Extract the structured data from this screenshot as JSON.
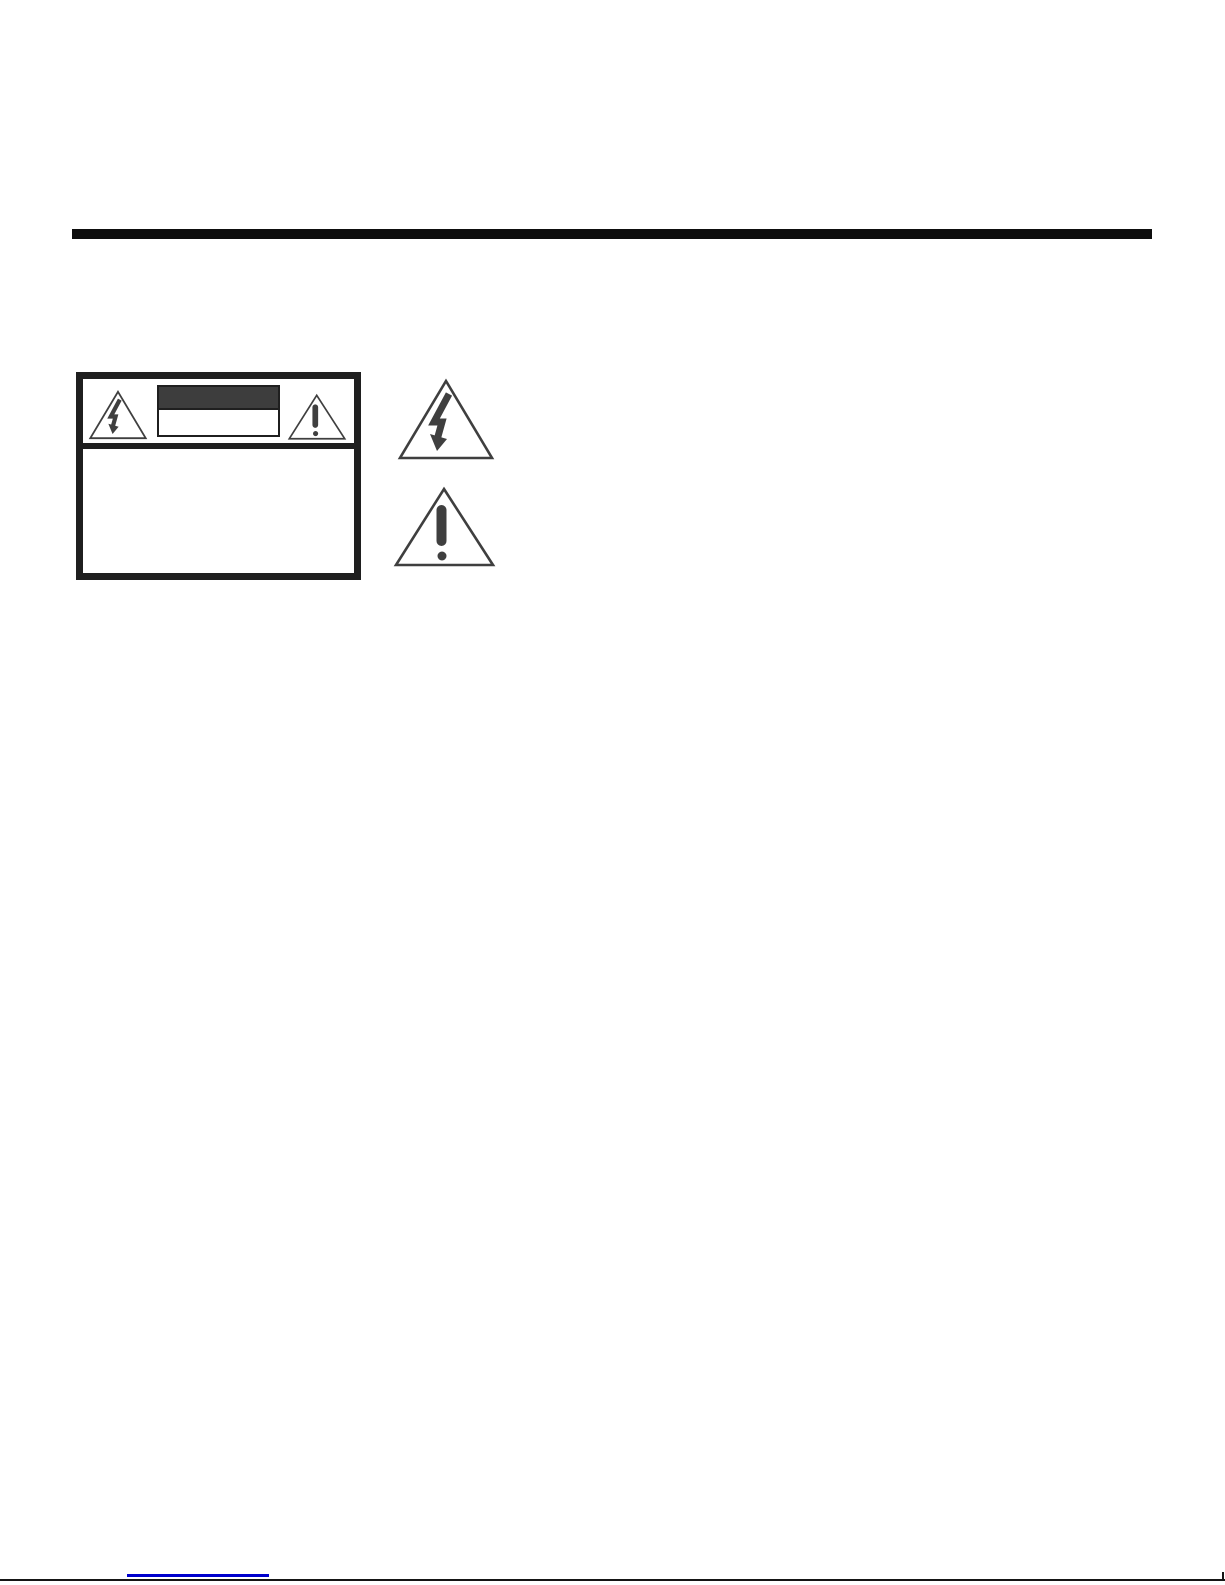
{
  "page": {
    "background_color": "#ffffff",
    "width_px": 1225,
    "height_px": 1585
  },
  "top_rule": {
    "color": "#0e0e0e"
  },
  "safety_label": {
    "border_color": "#1f1f1f",
    "header": {
      "left_icon": "electric-shock-triangle-icon",
      "right_icon": "alert-triangle-icon",
      "caution_band": {
        "top_fill": "#3d3d3d",
        "bottom_fill": "#ffffff",
        "border_color": "#1f1f1f"
      }
    }
  },
  "symbol_key": {
    "glyph_color": "#3f3f3f",
    "items": [
      {
        "icon": "lightning-bolt-in-triangle-icon"
      },
      {
        "icon": "exclamation-mark-in-triangle-icon"
      }
    ]
  },
  "footer": {
    "hyperlink_underline": {
      "color": "#0000cc"
    },
    "page_edge": {
      "color": "#151515"
    }
  }
}
